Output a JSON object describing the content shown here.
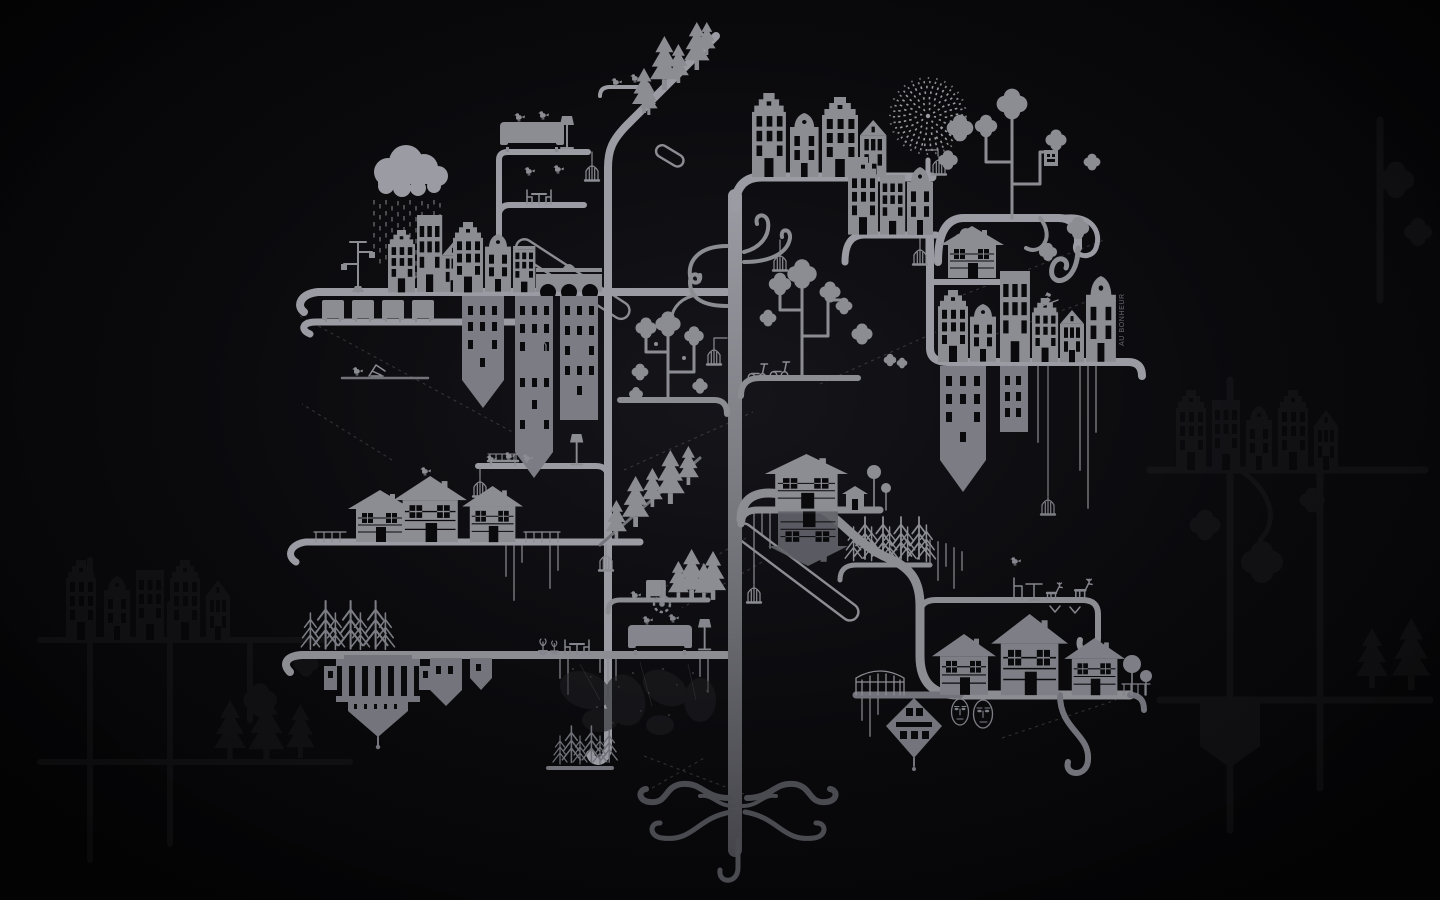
{
  "scene": {
    "sign_text": "AU BONHEUR",
    "palette": {
      "bg_center": "#15151a",
      "bg_mid": "#0a0a0d",
      "bg_edge": "#040405",
      "ink": "#8c8c93",
      "ink_bright": "#9b9ca3",
      "ink_low": "#72737a",
      "ink_dim": "#5b5c63",
      "window": "#0a0a0d",
      "root": "#4a4a51",
      "sign": "#6a6a71"
    },
    "motifs": [
      "tree-trunk",
      "curly-branch-shelves",
      "root-curls",
      "amsterdam-canal-houses",
      "chalet-houses",
      "hanging-inverted-buildings",
      "rain-cloud",
      "dotted-dandelion",
      "quatrefoil-blossom-trees",
      "pine-tree-clusters",
      "hanging-birdcages",
      "perched-birds",
      "sofa-with-birds",
      "armchair-row",
      "table-and-chairs",
      "street-lamp",
      "hanging-temple",
      "hanging-diamond-house",
      "two-faces",
      "witch-on-broom",
      "scooters",
      "deer-figures",
      "paint-drips",
      "dashed-diagonal-lines",
      "capsule-branches",
      "grunge-splatter",
      "faint-background-city-pattern"
    ]
  }
}
